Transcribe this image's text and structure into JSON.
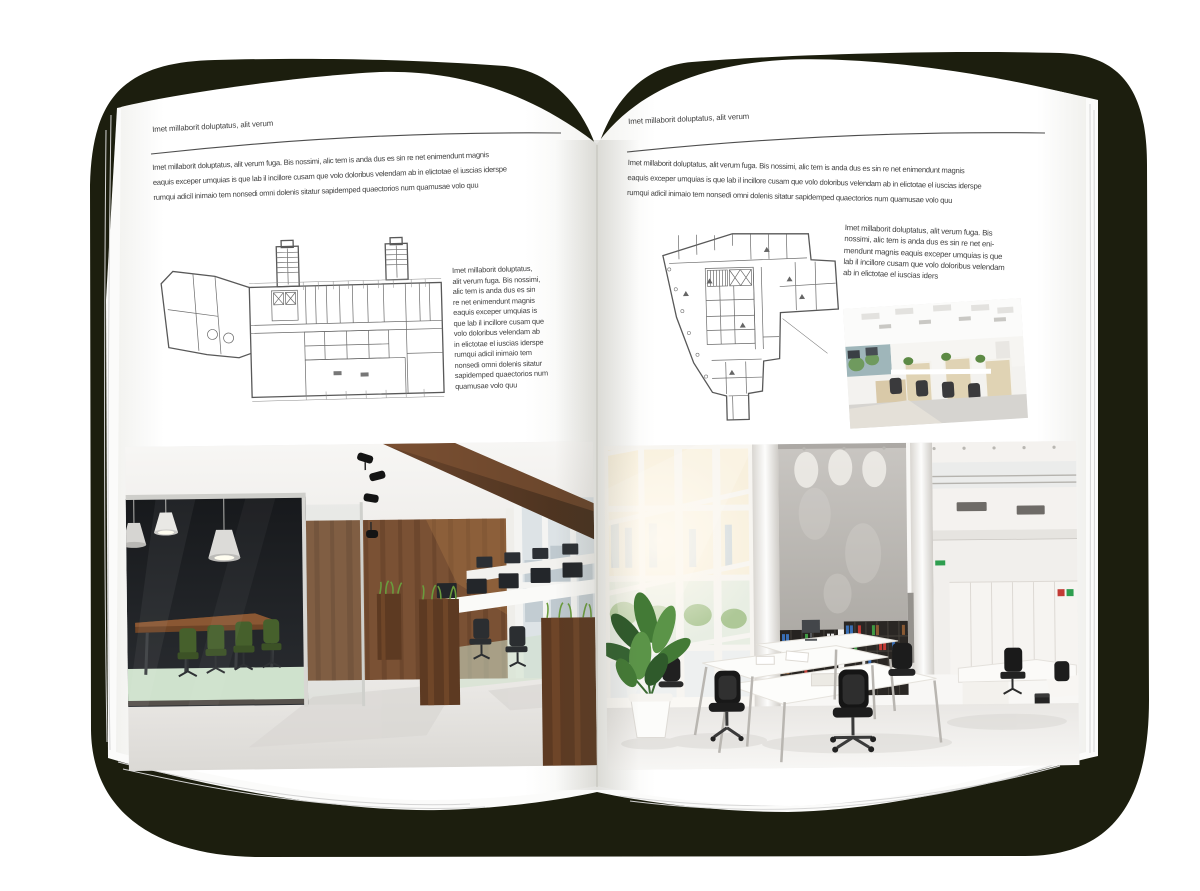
{
  "left_page": {
    "header": "Imet millaborit doluptatus, alit verum",
    "intro": "Imet millaborit doluptatus, alit verum fuga. Bis nossimi, alic tem is anda dus es sin re net enimendunt magnis\neaquis exceper umquias is que lab il incillore cusam que volo doloribus velendam ab in elictotae el iuscias iderspe\nrumqui adicil inimaio tem nonsedi omni dolenis sitatur sapidemped quaectorios num quamusae volo quu",
    "side_text": "Imet millaborit doluptatus,\nalit verum fuga. Bis nossimi,\nalic tem is anda dus es sin\nre net enimendunt magnis\neaquis exceper umquias is\nque lab il incillore cusam que\nvolo doloribus velendam ab\nin elictotae el iuscias iderspe\nrumqui adicil inimaio tem\nnonsedi omni dolenis sitatur\nsapidemped quaectorios num\nquamusae volo quu"
  },
  "right_page": {
    "header": "Imet millaborit doluptatus, alit verum",
    "intro": "Imet millaborit doluptatus, alit verum fuga. Bis nossimi, alic tem is anda dus es sin re net enimendunt magnis\neaquis exceper umquias is que lab il incillore cusam que volo doloribus velendam ab in elictotae el iuscias iderspe\nrumqui adicil inimaio tem nonsedi omni dolenis sitatur sapidemped quaectorios num quamusae volo quu",
    "side_text": "Imet millaborit doluptatus, alit verum fuga. Bis\nnossimi, alic tem is anda dus es sin re net eni-\nmendunt magnis eaquis exceper umquias is que\nlab il incillore cusam que volo doloribus velendam\nab in elictotae el iuscias iders"
  },
  "colors": {
    "backdrop": "#1c1e0e",
    "page": "#ffffff",
    "ink": "#404040",
    "rule": "#4e4e4e",
    "plan": "#585858",
    "wood_wall": "#7a5134",
    "meeting_chair_green": "#46602c",
    "planter_grass": "#6a9c3d",
    "binder_red": "#c23b35",
    "binder_green": "#3f9a44",
    "binder_blue": "#3a6fb5"
  }
}
